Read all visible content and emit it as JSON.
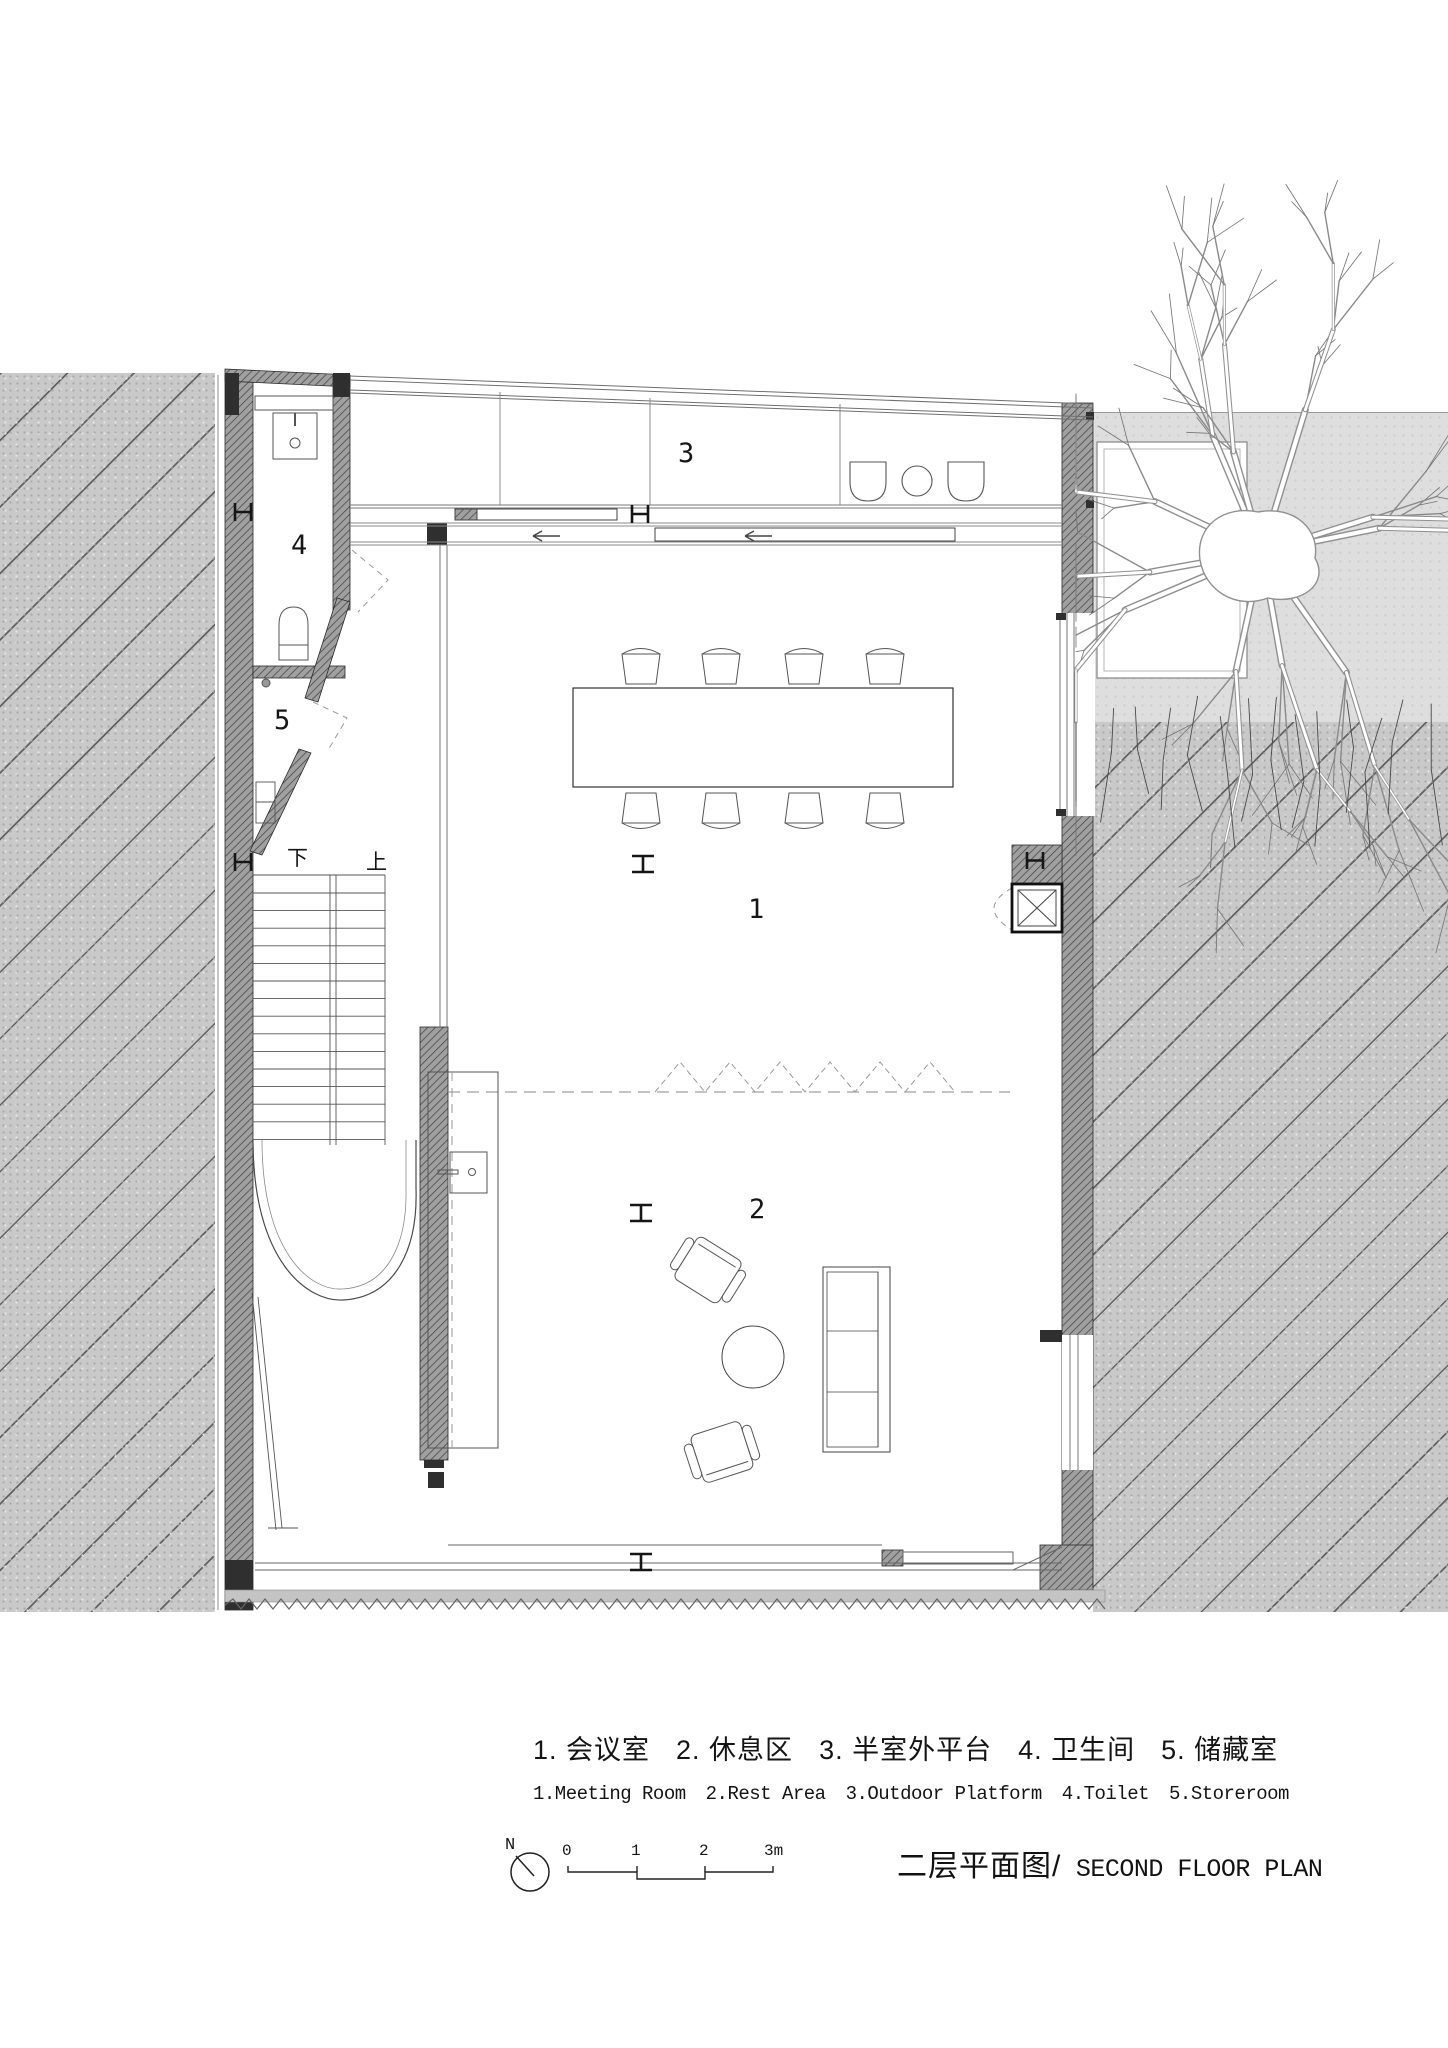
{
  "plan": {
    "labels": {
      "room1": "1",
      "room2": "2",
      "room3": "3",
      "room4": "4",
      "room5": "5",
      "stairs_down": "下",
      "stairs_up": "上"
    }
  },
  "legend": {
    "items": [
      {
        "zh": "1. 会议室",
        "en": "1.Meeting Room"
      },
      {
        "zh": "2. 休息区",
        "en": "2.Rest Area"
      },
      {
        "zh": "3. 半室外平台",
        "en": "3.Outdoor Platform"
      },
      {
        "zh": "4. 卫生间",
        "en": "4.Toilet"
      },
      {
        "zh": "5. 储藏室",
        "en": "5.Storeroom"
      }
    ]
  },
  "titleblock": {
    "north_label": "N",
    "scale_ticks": [
      "0",
      "1",
      "2",
      "3m"
    ],
    "title_zh": "二层平面图/",
    "title_en": " SECOND FLOOR PLAN"
  },
  "colors": {
    "line_dark": "#222222",
    "line_light": "#888888",
    "wall_fill": "#a0a0a0",
    "wall_hatch": "#454545",
    "ground_gray": "#c9c9c9",
    "courtyard_gray": "#dedede",
    "paper": "#ffffff"
  }
}
